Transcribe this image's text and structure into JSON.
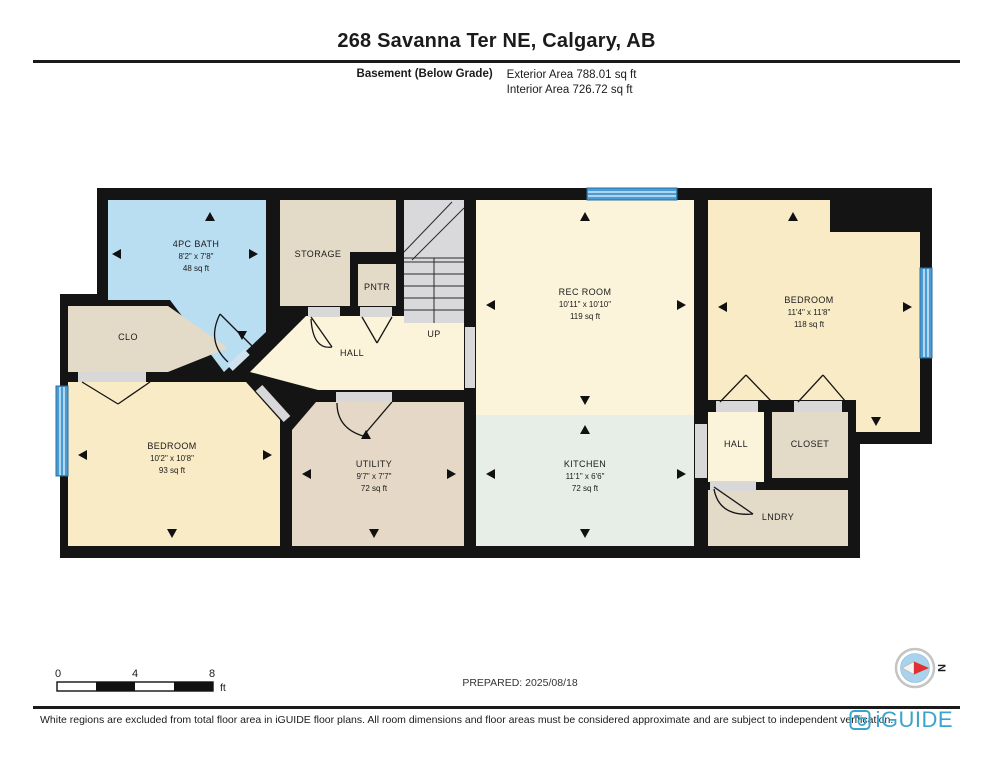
{
  "header": {
    "title": "268 Savanna Ter NE, Calgary, AB",
    "floor_label": "Basement (Below Grade)",
    "exterior_area": "Exterior Area 788.01 sq ft",
    "interior_area": "Interior Area 726.72 sq ft"
  },
  "rooms": {
    "bath": {
      "name": "4PC BATH",
      "dims": "8'2\" x 7'8\"",
      "area": "48 sq ft"
    },
    "storage": {
      "name": "STORAGE"
    },
    "pantry": {
      "name": "PNTR"
    },
    "stairs": {
      "name": "UP"
    },
    "rec_room": {
      "name": "REC ROOM",
      "dims": "10'11\" x 10'10\"",
      "area": "119 sq ft"
    },
    "bedroom_right": {
      "name": "BEDROOM",
      "dims": "11'4\" x 11'8\"",
      "area": "118 sq ft"
    },
    "closet_left": {
      "name": "CLO"
    },
    "hall": {
      "name": "HALL"
    },
    "bedroom_left": {
      "name": "BEDROOM",
      "dims": "10'2\" x 10'8\"",
      "area": "93 sq ft"
    },
    "utility": {
      "name": "UTILITY",
      "dims": "9'7\" x 7'7\"",
      "area": "72 sq ft"
    },
    "kitchen": {
      "name": "KITCHEN",
      "dims": "11'1\" x 6'6\"",
      "area": "72 sq ft"
    },
    "hall_right": {
      "name": "HALL"
    },
    "closet_right": {
      "name": "CLOSET"
    },
    "laundry": {
      "name": "LNDRY"
    }
  },
  "scale_bar": {
    "start": "0",
    "mid": "4",
    "end": "8",
    "unit": "ft"
  },
  "prepared": "PREPARED: 2025/08/18",
  "compass": {
    "north_label": "N"
  },
  "footer": {
    "disclaimer": "White regions are excluded from total floor area in iGUIDE floor plans. All room dimensions and floor areas must be considered approximate and are subject to independent verification.",
    "brand": "iGUIDE"
  },
  "colors": {
    "bath_blue": "#b9ddf1",
    "cream": "#fbf4da",
    "bedroom_yellow": "#f8ebc6",
    "kitchen_sage": "#e7eee7",
    "beige": "#e4dac8",
    "utility_tan": "#e5d8c6",
    "stairs_gray": "#d9d9dc",
    "window_blue": "#4a9cd6",
    "wall_black": "#141414",
    "brand_blue": "#3aa4cd"
  }
}
